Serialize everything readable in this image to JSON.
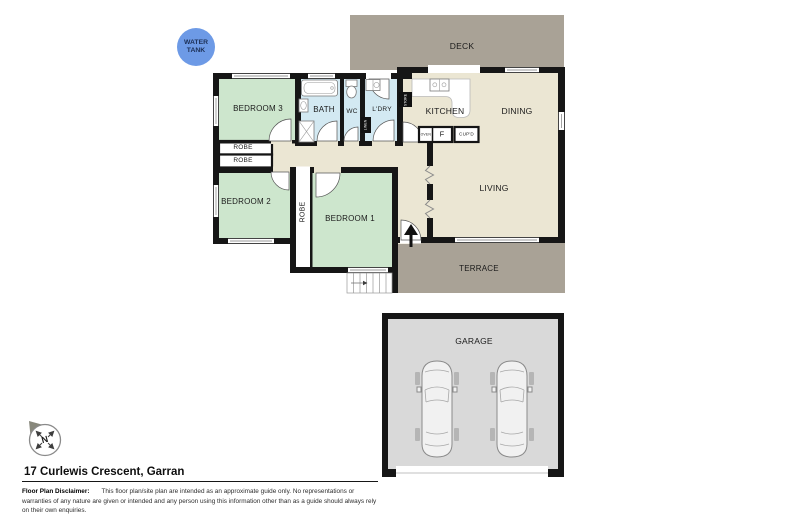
{
  "title": {
    "address": "17 Curlewis Crescent, Garran"
  },
  "disclaimer": {
    "label": "Floor Plan Disclaimer:",
    "text": "This floor plan/site plan are intended as an approximate guide only. No representations or warranties of any nature are given or intended and any person using this information other than as a guide should always rely on their own enquiries."
  },
  "site": {
    "water_tank_label": "WATER\nTANK",
    "compass_label": "N"
  },
  "rooms": {
    "deck": "DECK",
    "bedroom3": "BEDROOM 3",
    "bath": "BATH",
    "wc": "WC",
    "laundry": "L'DRY",
    "kitchen": "KITCHEN",
    "dining": "DINING",
    "living": "LIVING",
    "terrace": "TERRACE",
    "bedroom2": "BEDROOM 2",
    "bedroom1": "BEDROOM 1",
    "garage": "GARAGE",
    "robe_a": "ROBE",
    "robe_b": "ROBE",
    "robe_c": "ROBE"
  },
  "fixtures": {
    "linen": "LINEN",
    "store": "STORE",
    "oven": "OVEN",
    "fridge": "F",
    "cupboard": "CUP'D"
  },
  "colors": {
    "wall": "#161616",
    "bedroom": "#cde6cd",
    "wet_area": "#d3e9f2",
    "interior": "#ebe6d3",
    "outdoor": "#a9a296",
    "garage_floor": "#d9d9d9",
    "water_tank": "#6d9ae6",
    "tank_text": "#1c2f55"
  }
}
